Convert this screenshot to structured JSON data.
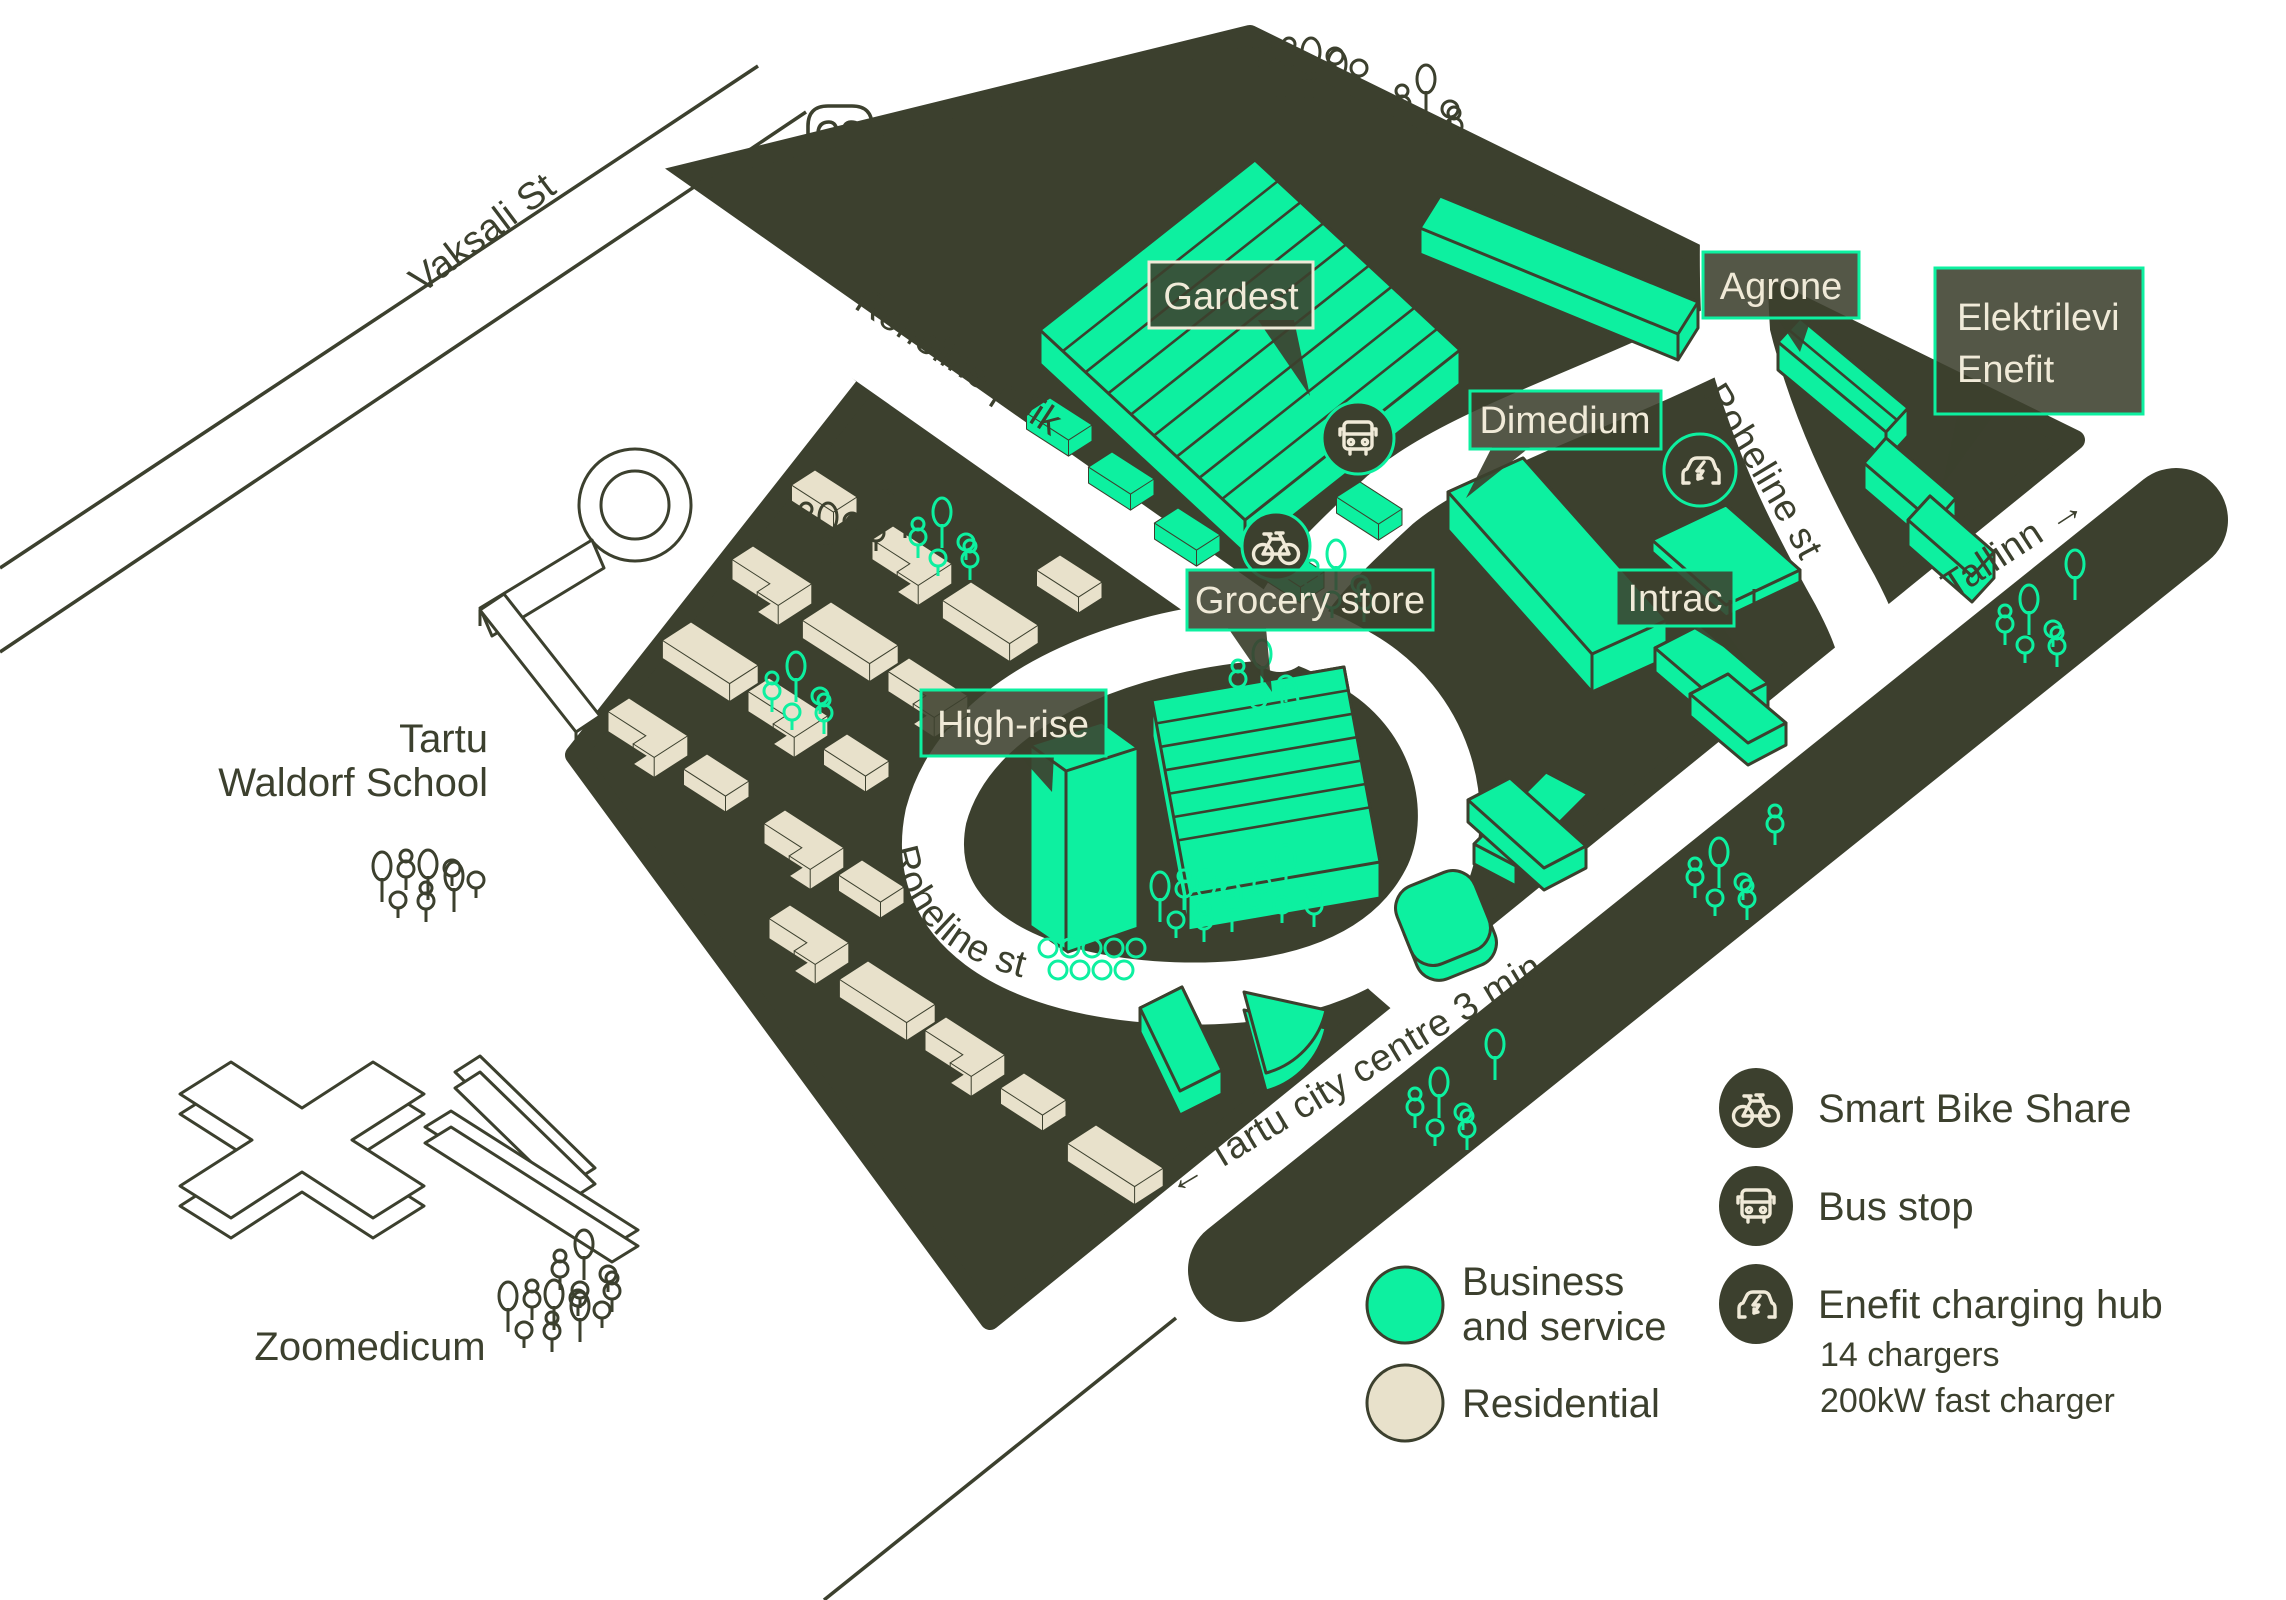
{
  "map": {
    "streets": {
      "vaksali": "Vaksali St",
      "roheline_poik": "Roheline põik",
      "roheline_st_north": "Roheline st",
      "roheline_st_loop": "Roheline st",
      "tallinn": "Tallinn →",
      "city_centre": "← Tartu city centre 3 min"
    },
    "areas": {
      "waldorf_line1": "Tartu",
      "waldorf_line2": "Waldorf School",
      "zoomedicum": "Zoomedicum"
    },
    "callouts": {
      "gardest": "Gardest",
      "agrone": "Agrone",
      "elektrilevi_line1": "Elektrilevi",
      "elektrilevi_line2": "Enefit",
      "dimedium": "Dimedium",
      "intrac": "Intrac",
      "grocery": "Grocery store",
      "high_rise": "High-rise"
    }
  },
  "legend": {
    "bike": "Smart Bike Share",
    "bus": "Bus stop",
    "ev": "Enefit charging hub",
    "ev_sub1": "14 chargers",
    "ev_sub2": "200kW fast charger",
    "business_line1": "Business",
    "business_line2": "and service",
    "residential": "Residential"
  },
  "colors": {
    "dark_olive": "#3C402E",
    "brand_green": "#0DF0A0",
    "residential_beige": "#E8E1CB",
    "label_text": "#F0EAD8",
    "background": "#FFFFFF"
  }
}
